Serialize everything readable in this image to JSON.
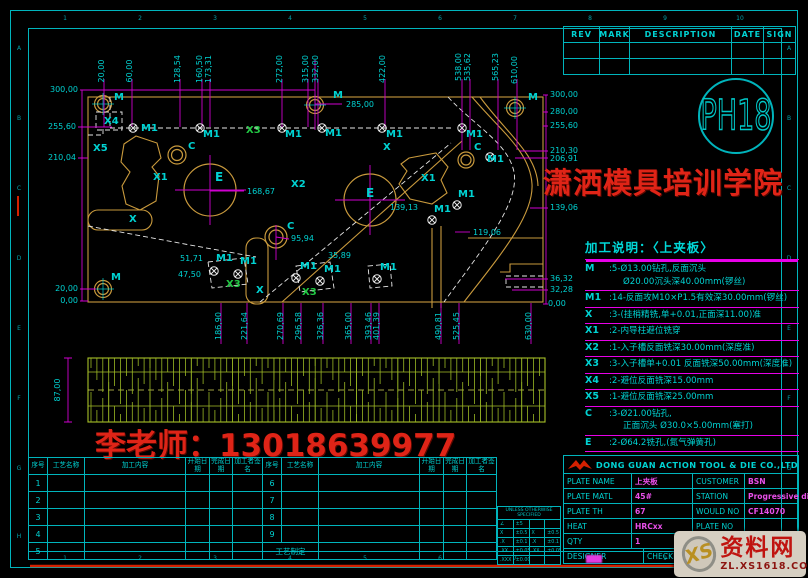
{
  "rev_table": {
    "headers": [
      "REV",
      "MARK",
      "DESCRIPTION",
      "DATE",
      "SIGN"
    ],
    "empty_rows": 2
  },
  "logo_text": "PH18",
  "watermark_school": "潇洒模具培训学院",
  "watermark_phone": "李老师：13018639977",
  "notes": {
    "title": "加工说明：〈上夹板〉",
    "items": [
      {
        "key": "M",
        "lines": [
          ":5-Ø13.00钻孔,反面沉头",
          "Ø20.00沉头深40.00mm(锣丝)"
        ]
      },
      {
        "key": "M1",
        "lines": [
          ":14-反面攻M10×P1.5有效深30.00mm(锣丝)"
        ]
      },
      {
        "key": "X",
        "lines": [
          ":3-(挂梢精铣,单+0.01,正面深11.00)准"
        ]
      },
      {
        "key": "X1",
        "lines": [
          ":2-内导柱避位铣穿"
        ]
      },
      {
        "key": "X2",
        "lines": [
          ":1-入子槽反面铣深30.00mm(深度准)"
        ]
      },
      {
        "key": "X3",
        "lines": [
          ":3-入子槽单+0.01 反面铣深50.00mm(深度准)"
        ]
      },
      {
        "key": "X4",
        "lines": [
          ":2-避位反面铣深15.00mm"
        ]
      },
      {
        "key": "X5",
        "lines": [
          ":1-避位反面铣深25.00mm"
        ]
      },
      {
        "key": "C",
        "lines": [
          ":3-Ø21.00钻孔,",
          "正面沉头 Ø30.0×5.00mm(塞打)"
        ]
      },
      {
        "key": "E",
        "lines": [
          ":2-Ø64.2铣孔,(氮气弹簧孔)"
        ]
      }
    ]
  },
  "process_tables": {
    "headers": [
      "序号",
      "工艺名称",
      "加工内容",
      "开始日期",
      "完成日期",
      "加工者签名"
    ],
    "table1_rows": [
      "1",
      "2",
      "3",
      "4",
      "5"
    ],
    "table2_rows": [
      "6",
      "7",
      "8",
      "9"
    ],
    "footer": "工艺制定"
  },
  "tolerance_box": {
    "title": "UNLESS OTHERWISE SPECIFIED",
    "rows": [
      [
        "∠",
        "±5",
        "",
        ""
      ],
      [
        "X",
        "±0.5",
        "X",
        "±0.5"
      ],
      [
        ".X",
        "±0.1",
        ".X",
        "±0.1"
      ],
      [
        ".XX",
        "±0.05",
        ".XX",
        "±0.05"
      ],
      [
        ".XXX",
        "±0.005",
        "",
        ""
      ]
    ]
  },
  "title_block": {
    "company": "DONG GUAN ACTION TOOL & DIE CO.,LTD",
    "rows": [
      [
        [
          "PLATE NAME",
          64,
          "l"
        ],
        [
          "上夹板",
          57,
          "v"
        ],
        [
          "CUSTOMER",
          48,
          "l"
        ],
        [
          "BSN",
          63,
          "v"
        ]
      ],
      [
        [
          "PLATE MATL",
          64,
          "l"
        ],
        [
          "45#",
          57,
          "v"
        ],
        [
          "STATION",
          48,
          "l"
        ],
        [
          "Progressive die",
          63,
          "v"
        ]
      ],
      [
        [
          "PLATE TH",
          64,
          "l"
        ],
        [
          "67",
          57,
          "v"
        ],
        [
          "WOULD NO",
          48,
          "l"
        ],
        [
          "CF14070",
          63,
          "v"
        ]
      ],
      [
        [
          "HEAT",
          64,
          "l"
        ],
        [
          "HRCxx",
          57,
          "v"
        ],
        [
          "PLATE NO",
          48,
          "l"
        ],
        [
          "",
          63,
          "v"
        ]
      ],
      [
        [
          "QTY",
          64,
          "l"
        ],
        [
          "1",
          57,
          "v"
        ],
        [
          "SCALE",
          48,
          "l"
        ],
        [
          "1:1",
          27,
          "c"
        ],
        [
          "PAGE",
          36,
          "l"
        ]
      ],
      [
        [
          "DESIGNER",
          76,
          "l"
        ],
        [
          "CHECKED",
          60,
          "l"
        ],
        [
          "APPROVED",
          96,
          "l"
        ]
      ]
    ]
  },
  "site_watermark": {
    "logo": "XS",
    "name": "资料网",
    "url": "ZL.XS1618.COM"
  },
  "zones": {
    "letters": [
      "A",
      "B",
      "C",
      "D",
      "E",
      "F",
      "G",
      "H"
    ],
    "numbers": [
      "1",
      "2",
      "3",
      "4",
      "5",
      "6",
      "7",
      "8",
      "9",
      "10"
    ]
  },
  "drawing": {
    "labels": [
      {
        "t": "20,00",
        "x": 104,
        "y": 71,
        "r": -90,
        "c": "dim"
      },
      {
        "t": "60,00",
        "x": 132,
        "y": 71,
        "r": -90,
        "c": "dim"
      },
      {
        "t": "128,54",
        "x": 180,
        "y": 69,
        "r": -90,
        "c": "dim"
      },
      {
        "t": "160,50",
        "x": 202,
        "y": 69,
        "r": -90,
        "c": "dim"
      },
      {
        "t": "173,31",
        "x": 211,
        "y": 69,
        "r": -90,
        "c": "dim"
      },
      {
        "t": "272,00",
        "x": 282,
        "y": 69,
        "r": -90,
        "c": "dim"
      },
      {
        "t": "315,00",
        "x": 308,
        "y": 69,
        "r": -90,
        "c": "dim"
      },
      {
        "t": "332,00",
        "x": 318,
        "y": 69,
        "r": -90,
        "c": "dim"
      },
      {
        "t": "422,00",
        "x": 385,
        "y": 69,
        "r": -90,
        "c": "dim"
      },
      {
        "t": "538,00",
        "x": 461,
        "y": 67,
        "r": -90,
        "c": "dim"
      },
      {
        "t": "535,62",
        "x": 470,
        "y": 67,
        "r": -90,
        "c": "dim"
      },
      {
        "t": "565,23",
        "x": 498,
        "y": 67,
        "r": -90,
        "c": "dim"
      },
      {
        "t": "610,00",
        "x": 517,
        "y": 70,
        "r": -90,
        "c": "dim"
      },
      {
        "t": "300,00",
        "x": 78,
        "y": 92,
        "a": "end",
        "c": "dim"
      },
      {
        "t": "255,60",
        "x": 76,
        "y": 129,
        "a": "end",
        "c": "dim"
      },
      {
        "t": "210,04",
        "x": 76,
        "y": 160,
        "a": "end",
        "c": "dim"
      },
      {
        "t": "20,00",
        "x": 78,
        "y": 291,
        "a": "end",
        "c": "dim"
      },
      {
        "t": "0,00",
        "x": 78,
        "y": 303,
        "a": "end",
        "c": "dim"
      },
      {
        "t": "300,00",
        "x": 550,
        "y": 97,
        "c": "dim"
      },
      {
        "t": "280,00",
        "x": 550,
        "y": 114,
        "c": "dim"
      },
      {
        "t": "255,60",
        "x": 550,
        "y": 128,
        "c": "dim"
      },
      {
        "t": "210,30",
        "x": 550,
        "y": 153,
        "c": "dim"
      },
      {
        "t": "206,91",
        "x": 550,
        "y": 161,
        "c": "dim"
      },
      {
        "t": "139,06",
        "x": 550,
        "y": 210,
        "c": "dim"
      },
      {
        "t": "36,32",
        "x": 550,
        "y": 281,
        "c": "dim"
      },
      {
        "t": "32,28",
        "x": 550,
        "y": 292,
        "c": "dim"
      },
      {
        "t": "0,00",
        "x": 548,
        "y": 306,
        "c": "dim"
      },
      {
        "t": "186,90",
        "x": 221,
        "y": 326,
        "r": -90,
        "c": "dim"
      },
      {
        "t": "221,64",
        "x": 247,
        "y": 326,
        "r": -90,
        "c": "dim"
      },
      {
        "t": "270,69",
        "x": 283,
        "y": 326,
        "r": -90,
        "c": "dim"
      },
      {
        "t": "296,58",
        "x": 301,
        "y": 326,
        "r": -90,
        "c": "dim"
      },
      {
        "t": "326,36",
        "x": 323,
        "y": 326,
        "r": -90,
        "c": "dim"
      },
      {
        "t": "365,00",
        "x": 351,
        "y": 326,
        "r": -90,
        "c": "dim"
      },
      {
        "t": "393,46",
        "x": 371,
        "y": 326,
        "r": -90,
        "c": "dim"
      },
      {
        "t": "401,39",
        "x": 379,
        "y": 326,
        "r": -90,
        "c": "dim"
      },
      {
        "t": "490,81",
        "x": 441,
        "y": 326,
        "r": -90,
        "c": "dim"
      },
      {
        "t": "525,45",
        "x": 459,
        "y": 326,
        "r": -90,
        "c": "dim"
      },
      {
        "t": "630,00",
        "x": 531,
        "y": 326,
        "r": -90,
        "c": "dim"
      },
      {
        "t": "285,00",
        "x": 346,
        "y": 107,
        "c": "dim"
      },
      {
        "t": "168,67",
        "x": 247,
        "y": 194,
        "c": "dim"
      },
      {
        "t": "139,13",
        "x": 390,
        "y": 210,
        "c": "dim"
      },
      {
        "t": "119,06",
        "x": 473,
        "y": 235,
        "c": "dim"
      },
      {
        "t": "95,94",
        "x": 291,
        "y": 241,
        "c": "dim"
      },
      {
        "t": "35,89",
        "x": 328,
        "y": 258,
        "c": "dim"
      },
      {
        "t": "51,71",
        "x": 180,
        "y": 261,
        "c": "dim"
      },
      {
        "t": "47,50",
        "x": 178,
        "y": 277,
        "c": "dim"
      },
      {
        "t": "87,00",
        "x": 60,
        "y": 390,
        "r": -90,
        "c": "dim"
      },
      {
        "t": "M",
        "x": 114,
        "y": 100,
        "c": "lbl"
      },
      {
        "t": "M",
        "x": 333,
        "y": 98,
        "c": "lbl"
      },
      {
        "t": "M",
        "x": 528,
        "y": 100,
        "c": "lbl"
      },
      {
        "t": "M",
        "x": 111,
        "y": 280,
        "c": "lbl"
      },
      {
        "t": "M1",
        "x": 141,
        "y": 131,
        "c": "lbl"
      },
      {
        "t": "M1",
        "x": 203,
        "y": 137,
        "c": "lbl"
      },
      {
        "t": "M1",
        "x": 285,
        "y": 137,
        "c": "lbl"
      },
      {
        "t": "M1",
        "x": 325,
        "y": 136,
        "c": "lbl"
      },
      {
        "t": "M1",
        "x": 386,
        "y": 137,
        "c": "lbl"
      },
      {
        "t": "M1",
        "x": 466,
        "y": 137,
        "c": "lbl"
      },
      {
        "t": "M1",
        "x": 216,
        "y": 261,
        "c": "lbl"
      },
      {
        "t": "M1",
        "x": 240,
        "y": 264,
        "c": "lbl"
      },
      {
        "t": "M1",
        "x": 300,
        "y": 269,
        "c": "lbl"
      },
      {
        "t": "M1",
        "x": 324,
        "y": 272,
        "c": "lbl"
      },
      {
        "t": "M1",
        "x": 380,
        "y": 270,
        "c": "lbl"
      },
      {
        "t": "M1",
        "x": 434,
        "y": 212,
        "c": "lbl"
      },
      {
        "t": "M1",
        "x": 458,
        "y": 197,
        "c": "lbl"
      },
      {
        "t": "M1",
        "x": 487,
        "y": 162,
        "c": "lbl"
      },
      {
        "t": "X",
        "x": 129,
        "y": 222,
        "c": "lbl"
      },
      {
        "t": "X",
        "x": 256,
        "y": 293,
        "c": "lbl"
      },
      {
        "t": "X",
        "x": 383,
        "y": 150,
        "c": "lbl"
      },
      {
        "t": "X1",
        "x": 153,
        "y": 180,
        "c": "lbl"
      },
      {
        "t": "X1",
        "x": 421,
        "y": 181,
        "c": "lbl"
      },
      {
        "t": "X2",
        "x": 291,
        "y": 187,
        "c": "lbl"
      },
      {
        "t": "X3",
        "x": 246,
        "y": 133,
        "c": "grn"
      },
      {
        "t": "X3",
        "x": 226,
        "y": 287,
        "c": "grn"
      },
      {
        "t": "X3",
        "x": 302,
        "y": 295,
        "c": "grn"
      },
      {
        "t": "X4",
        "x": 104,
        "y": 124,
        "c": "lbl"
      },
      {
        "t": "X5",
        "x": 93,
        "y": 151,
        "c": "lbl"
      },
      {
        "t": "C",
        "x": 188,
        "y": 149,
        "c": "lbl"
      },
      {
        "t": "C",
        "x": 287,
        "y": 229,
        "c": "lbl"
      },
      {
        "t": "C",
        "x": 474,
        "y": 150,
        "c": "lbl"
      },
      {
        "t": "E",
        "x": 215,
        "y": 181,
        "c": "big"
      },
      {
        "t": "E",
        "x": 366,
        "y": 197,
        "c": "big"
      }
    ],
    "m1_markers": [
      [
        133,
        128
      ],
      [
        200,
        128
      ],
      [
        282,
        128
      ],
      [
        322,
        128
      ],
      [
        382,
        128
      ],
      [
        462,
        128
      ],
      [
        214,
        271
      ],
      [
        238,
        274
      ],
      [
        296,
        278
      ],
      [
        320,
        281
      ],
      [
        377,
        279
      ],
      [
        432,
        220
      ],
      [
        457,
        205
      ],
      [
        490,
        157
      ]
    ],
    "m_holes": [
      [
        103,
        104
      ],
      [
        103,
        289
      ],
      [
        315,
        105
      ],
      [
        515,
        108
      ]
    ],
    "c_holes": [
      [
        177,
        155,
        9,
        5.5
      ],
      [
        276,
        237,
        11,
        7
      ],
      [
        466,
        160,
        8,
        5
      ]
    ],
    "e_holes": [
      [
        210,
        190,
        26
      ],
      [
        370,
        200,
        26
      ]
    ]
  }
}
